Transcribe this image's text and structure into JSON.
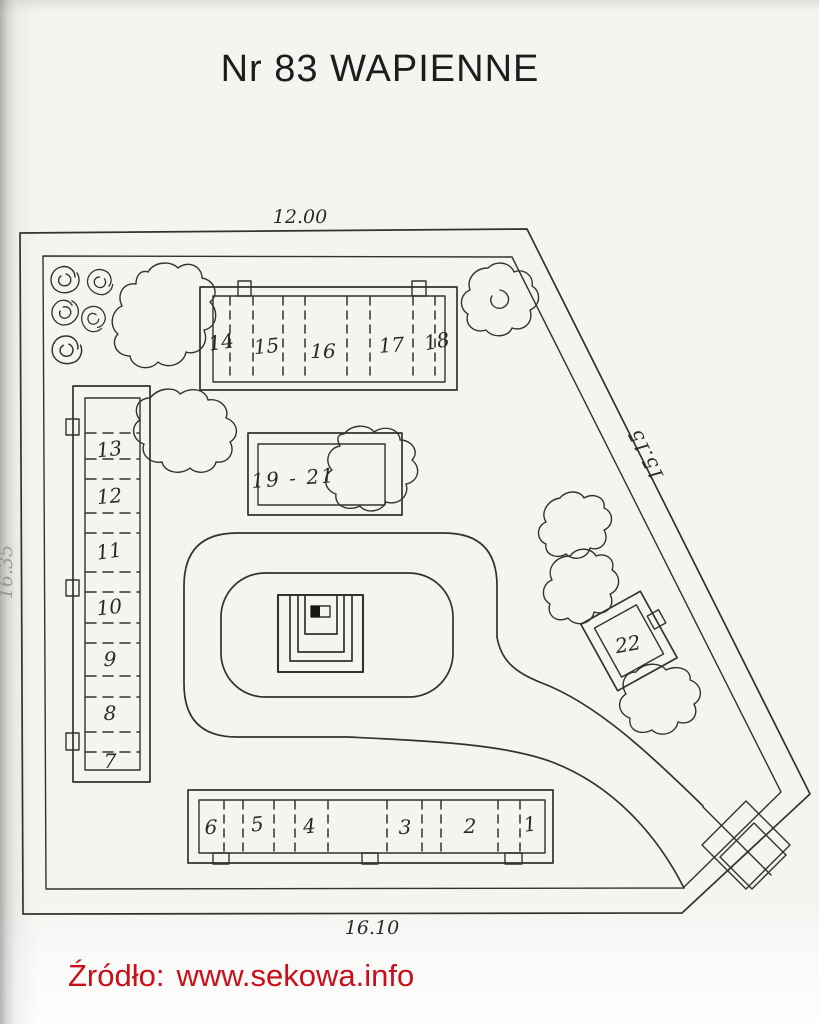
{
  "page": {
    "title": "Nr 83 WAPIENNE",
    "source_label": "Źródło:",
    "source_url": "www.sekowa.info"
  },
  "dimensions": {
    "top": "12.00",
    "bottom": "16.10",
    "left": "16.35",
    "right": "15.15"
  },
  "plots": {
    "top_row": [
      "14",
      "15",
      "16",
      "17",
      "18"
    ],
    "left_column": [
      "13",
      "12",
      "11",
      "10",
      "9",
      "8",
      "7"
    ],
    "middle_box": "19 - 21",
    "side_box": "22",
    "bottom_row": [
      "6",
      "5",
      "4",
      "3",
      "2",
      "1"
    ]
  },
  "icons": {
    "tree": "tree-canopy-blob",
    "bush": "spiral-bush",
    "monument": "central-monument-steps",
    "gate": "entrance-gate"
  },
  "colors": {
    "ink": "#34322e",
    "accent_red": "#c9101a",
    "paper": "#f5f4f1"
  }
}
